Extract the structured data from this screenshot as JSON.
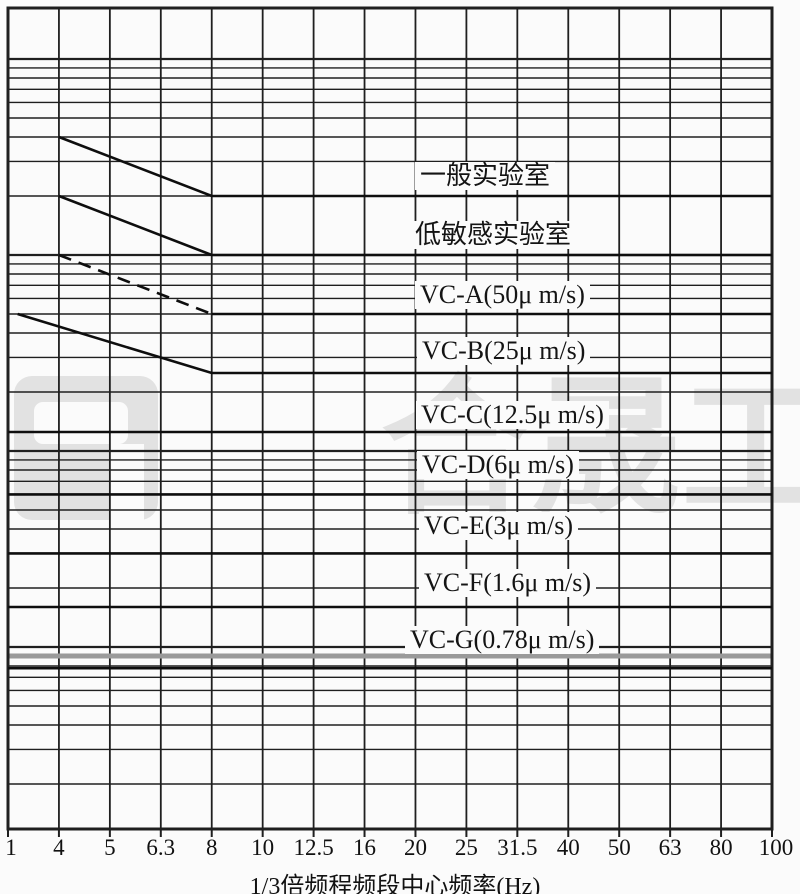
{
  "page": {
    "background": "#fbfbfb",
    "line_color": "#1f1f1f",
    "curve_color": "#0e0e0e",
    "watermark_color": "#e2e2e2",
    "artifact_gray_color": "#9a9a9a"
  },
  "watermark": {
    "text": "合晟工程",
    "logo": "company-logo-square"
  },
  "chart_data": {
    "type": "line",
    "title": "",
    "xlabel": "1/3倍频程频段中心频率(Hz)",
    "ylabel": "",
    "x_scale": "1/3-octave bands, log spacing, 1 Hz to 100 Hz",
    "y_scale": "log velocity (μm/s), no tick labels shown",
    "x_ticks": [
      "1",
      "4",
      "5",
      "6.3",
      "8",
      "10",
      "12.5",
      "16",
      "20",
      "25",
      "31.5",
      "40",
      "50",
      "63",
      "80",
      "100"
    ],
    "x_bands": [
      1,
      4,
      5,
      6.3,
      8,
      10,
      12.5,
      16,
      20,
      25,
      31.5,
      40,
      50,
      63,
      80,
      100
    ],
    "y_grid_majors": [
      1000,
      100,
      10,
      1
    ],
    "y_grid_minor_steps": [
      9,
      8,
      7,
      6,
      5,
      4,
      3,
      2
    ],
    "grid": true,
    "legend_position": "labels on curves",
    "series": [
      {
        "id": "general-lab",
        "label": "一般实验室",
        "velocity_um_s": 200,
        "points": [
          [
            4,
            400
          ],
          [
            8,
            200
          ],
          [
            100,
            200
          ]
        ],
        "slope_dashed": false,
        "label_x": 415,
        "label_cy": 176
      },
      {
        "id": "low-sensitivity-lab",
        "label": "低敏感实验室",
        "velocity_um_s": 100,
        "points": [
          [
            4,
            200
          ],
          [
            8,
            100
          ],
          [
            100,
            100
          ]
        ],
        "slope_dashed": false,
        "label_x": 410,
        "label_cy": 235
      },
      {
        "id": "vc-a",
        "label": "VC-A(50μ m/s)",
        "velocity_um_s": 50,
        "points": [
          [
            4,
            100
          ],
          [
            8,
            50
          ],
          [
            100,
            50
          ]
        ],
        "slope_dashed": true,
        "label_x": 415,
        "label_cy": 295
      },
      {
        "id": "vc-b",
        "label": "VC-B(25μ m/s)",
        "velocity_um_s": 25,
        "points": [
          [
            1.3,
            50
          ],
          [
            8,
            25
          ],
          [
            100,
            25
          ]
        ],
        "slope_dashed": false,
        "label_x": 417,
        "label_cy": 351
      },
      {
        "id": "vc-c",
        "label": "VC-C(12.5μ m/s)",
        "velocity_um_s": 12.5,
        "points": [
          [
            1,
            12.5
          ],
          [
            100,
            12.5
          ]
        ],
        "slope_dashed": false,
        "label_x": 416,
        "label_cy": 415
      },
      {
        "id": "vc-d",
        "label": "VC-D(6μ m/s)",
        "velocity_um_s": 6,
        "points": [
          [
            1,
            6
          ],
          [
            100,
            6
          ]
        ],
        "slope_dashed": false,
        "label_x": 417,
        "label_cy": 465
      },
      {
        "id": "vc-e",
        "label": "VC-E(3μ m/s)",
        "velocity_um_s": 3,
        "points": [
          [
            1,
            3
          ],
          [
            100,
            3
          ]
        ],
        "slope_dashed": false,
        "label_x": 419,
        "label_cy": 526
      },
      {
        "id": "vc-f",
        "label": "VC-F(1.6μ m/s)",
        "velocity_um_s": 1.6,
        "points": [
          [
            1,
            1.6
          ],
          [
            100,
            1.6
          ]
        ],
        "slope_dashed": false,
        "label_x": 419,
        "label_cy": 583
      },
      {
        "id": "vc-g",
        "label": "VC-G(0.78μ m/s)",
        "velocity_um_s": 0.78,
        "points": [
          [
            1,
            0.78
          ],
          [
            100,
            0.78
          ]
        ],
        "slope_dashed": false,
        "label_x": 405,
        "label_cy": 640
      }
    ]
  },
  "layout": {
    "plot_left": 8,
    "plot_top": 8,
    "plot_right": 772,
    "plot_bottom": 829,
    "y_ref_value": 100,
    "y_ref_px": 255,
    "decade_px": 196,
    "tick_label_y": 855,
    "artifact_gray_line_velocity": 0.9
  }
}
